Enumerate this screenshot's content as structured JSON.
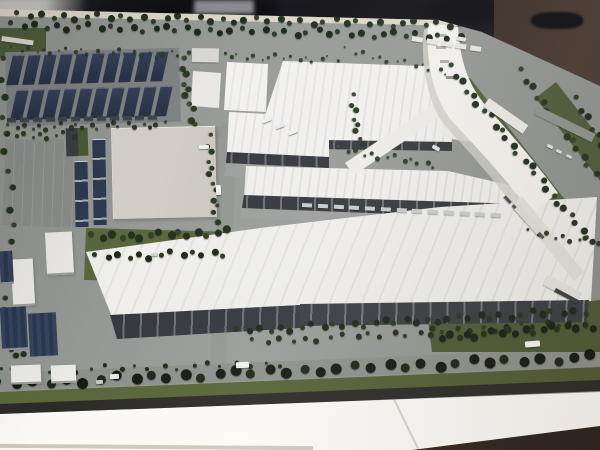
{
  "meta": {
    "description": "Photograph of an architectural scale model of a large factory campus (white plant halls, curved landmark tower, rooftop-solar carport field, perimeter canal and tree-lined boulevard) displayed on a white table in a dark room",
    "no_visible_text": true
  },
  "scene": {
    "regions": [
      {
        "label": "solar-carport-field",
        "position": "top-left"
      },
      {
        "label": "perimeter-canal",
        "position": "top and right"
      },
      {
        "label": "curved-landmark-tower",
        "position": "top-right"
      },
      {
        "label": "factory-halls",
        "position": "center"
      },
      {
        "label": "logistics-sheds",
        "position": "left"
      },
      {
        "label": "tree-lined-boulevard",
        "position": "bottom"
      },
      {
        "label": "white-display-table",
        "position": "bottom edge"
      },
      {
        "label": "dark-exhibition-room",
        "position": "top edge"
      }
    ]
  },
  "colors": {
    "bg": "#191921",
    "bg_blob": "#0e0e13",
    "bg_light": "#c4c3bf",
    "bg_brown": "#3a2f28",
    "pavement": "#90938f",
    "pavement_light": "#9da09c",
    "road": "#8d908b",
    "parking": "#8a8d89",
    "canal": "#4f7da6",
    "canal_hi": "#85aec9",
    "bank": "#4c5c39",
    "grass": "#5a673e",
    "grass_dark": "#4d5a36",
    "verge": "#5d6a3c",
    "tree": "#22301e",
    "tree_dark": "#141c12",
    "roof": "#eeedea",
    "roof_ridge": "#dedddb",
    "facade": "#35383d",
    "facade2": "#3a3d42",
    "flat": "#d7d3cb",
    "navy": "#2e3a51",
    "solar": "#36425a",
    "solar_dark": "#2a3448",
    "frame": "#ddd6c9",
    "table": "#f6f4ef",
    "table_sh": "#cdc7ba",
    "floor": "#43362e",
    "floor_dark": "#2a221d",
    "edge": "#2c2b27",
    "white_bldg": "#eae9e5"
  },
  "solar_field": {
    "rows": 2,
    "cols": 10,
    "strip_w": 12,
    "strip_h": 30,
    "gap_x": 4,
    "row_gap": 5,
    "row_shift": 3
  },
  "tree_bands": [
    {
      "name": "treeline-top-outer",
      "x": 16,
      "y": 15,
      "len": 452,
      "ang": 1.2,
      "count": 40,
      "size": 6,
      "c1": "#23321f",
      "c2": "#2e4026"
    },
    {
      "name": "treeline-top-inner",
      "x": 10,
      "y": 25,
      "len": 458,
      "ang": 1.4,
      "count": 42,
      "size": 6,
      "c1": "#1d2a1b",
      "c2": "#2a3a24"
    },
    {
      "name": "canal-top-bushes",
      "x": 12,
      "y": 49,
      "len": 330,
      "ang": 1.8,
      "count": 44,
      "size": 3,
      "c1": "#2f4129",
      "c2": "#3a4d31"
    },
    {
      "name": "treeline-canal-right-west",
      "x": 449,
      "y": 66,
      "len": 235,
      "ang": 51,
      "count": 26,
      "size": 6,
      "c1": "#22301e",
      "c2": "#2e4027"
    },
    {
      "name": "treeline-canal-right-east",
      "x": 519,
      "y": 70,
      "len": 230,
      "ang": 53,
      "count": 24,
      "size": 6,
      "c1": "#26341f",
      "c2": "#32442a"
    },
    {
      "name": "treeline-right-edge",
      "x": 574,
      "y": 98,
      "len": 210,
      "ang": 56,
      "count": 20,
      "size": 6,
      "c1": "#202d1c",
      "c2": "#2b3b22"
    },
    {
      "name": "treeline-below-solar",
      "x": 8,
      "y": 127,
      "len": 162,
      "ang": -1,
      "count": 22,
      "size": 4,
      "c1": "#2a3a23",
      "c2": "#354830"
    },
    {
      "name": "grove-center-left-a",
      "x": 90,
      "y": 237,
      "len": 142,
      "ang": -2,
      "count": 15,
      "size": 7,
      "c1": "#22301d",
      "c2": "#31432a"
    },
    {
      "name": "grove-center-left-b",
      "x": 94,
      "y": 257,
      "len": 138,
      "ang": -2,
      "count": 13,
      "size": 6,
      "c1": "#1d2a1a",
      "c2": "#293821"
    },
    {
      "name": "treeline-b6-east",
      "x": 208,
      "y": 135,
      "len": 92,
      "ang": 84,
      "count": 12,
      "size": 5,
      "c1": "#28381f",
      "c2": "#33452a"
    },
    {
      "name": "grove-solar-east",
      "x": 182,
      "y": 58,
      "len": 72,
      "ang": 80,
      "count": 10,
      "size": 6,
      "c1": "#2b3b24",
      "c2": "#364830"
    },
    {
      "name": "treeline-b1-east",
      "x": 351,
      "y": 95,
      "len": 56,
      "ang": 78,
      "count": 8,
      "size": 5,
      "c1": "#2a3a23",
      "c2": "#344630"
    },
    {
      "name": "treeline-apron",
      "x": 338,
      "y": 149,
      "len": 104,
      "ang": 9,
      "count": 13,
      "size": 4,
      "c1": "#2e3f26",
      "c2": "#395032"
    },
    {
      "name": "treeline-facade-south-a",
      "x": 236,
      "y": 331,
      "len": 356,
      "ang": -3.4,
      "count": 34,
      "size": 6,
      "c1": "#1c281a",
      "c2": "#28361f"
    },
    {
      "name": "treeline-facade-south-b",
      "x": 252,
      "y": 342,
      "len": 330,
      "ang": -3.4,
      "count": 26,
      "size": 5,
      "c1": "#232f1d",
      "c2": "#2d3c24"
    },
    {
      "name": "treeline-boulevard",
      "x": -6,
      "y": 384,
      "len": 610,
      "ang": -2.6,
      "count": 36,
      "size": 10,
      "c1": "#141c12",
      "c2": "#1d2817"
    },
    {
      "name": "treeline-road-north",
      "x": 2,
      "y": 371,
      "len": 290,
      "ang": -1.6,
      "count": 20,
      "size": 4,
      "c1": "#202c1a",
      "c2": "#2a3a22"
    },
    {
      "name": "treeline-west-edge",
      "x": 1,
      "y": 58,
      "len": 330,
      "ang": 86,
      "count": 18,
      "size": 6,
      "c1": "#253420",
      "c2": "#2f4128"
    },
    {
      "name": "treeline-parking-north",
      "x": 6,
      "y": 135,
      "len": 72,
      "ang": 0,
      "count": 9,
      "size": 4,
      "c1": "#2b3b24",
      "c2": "#354830"
    },
    {
      "name": "grove-parking-southeast",
      "x": 430,
      "y": 338,
      "len": 168,
      "ang": -4.5,
      "count": 20,
      "size": 7,
      "c1": "#182315",
      "c2": "#243018"
    },
    {
      "name": "grove-southwest",
      "x": 3,
      "y": 298,
      "len": 82,
      "ang": 80,
      "count": 10,
      "size": 6,
      "c1": "#22301d",
      "c2": "#2c3a24"
    },
    {
      "name": "canal-bend-bushes",
      "x": 345,
      "y": 50,
      "len": 112,
      "ang": 12,
      "count": 13,
      "size": 3,
      "c1": "#31422a",
      "c2": "#3c5033"
    },
    {
      "name": "treeline-b5-northeast",
      "x": 528,
      "y": 232,
      "len": 75,
      "ang": 8,
      "count": 9,
      "size": 4,
      "c1": "#2c3c25",
      "c2": "#364a2e"
    }
  ],
  "dash_rows": [
    {
      "name": "carport-row",
      "x": 7,
      "y": 120,
      "len": 154,
      "ang": -1,
      "count": 12,
      "w": 9,
      "h": 4,
      "c": "#40454c"
    },
    {
      "name": "dock-container-row",
      "x": 302,
      "y": 205,
      "len": 205,
      "ang": 3,
      "count": 13,
      "w": 10,
      "h": 4,
      "c": "#c6cacb"
    },
    {
      "name": "canal-top-station",
      "x": 412,
      "y": 38,
      "len": 74,
      "ang": 9,
      "count": 5,
      "w": 11,
      "h": 5,
      "c": "#e7e5e0"
    },
    {
      "name": "rail-platform-dashes",
      "x": 505,
      "y": 196,
      "len": 60,
      "ang": 47,
      "count": 5,
      "w": 9,
      "h": 3,
      "c": "#4a4e52"
    }
  ],
  "platforms": [
    {
      "name": "canal-station-west",
      "x": 489,
      "y": 98,
      "w": 48,
      "h": 10,
      "rot": 35,
      "c": "#eae8e3"
    },
    {
      "name": "canal-station-mid",
      "x": 520,
      "y": 204,
      "w": 34,
      "h": 8,
      "rot": 48,
      "c": "#dddcd6"
    },
    {
      "name": "canal-station-south",
      "x": 548,
      "y": 275,
      "w": 38,
      "h": 11,
      "rot": 28,
      "c": "#e4e2dd"
    },
    {
      "name": "canal-bridge-road",
      "x": 538,
      "y": 106,
      "w": 64,
      "h": 9,
      "rot": 26,
      "c": "#90938f"
    },
    {
      "name": "station-platform-dark",
      "x": 556,
      "y": 288,
      "w": 26,
      "h": 4,
      "rot": 28,
      "c": "#3c4046"
    },
    {
      "name": "gatehouse",
      "x": 192,
      "y": 48,
      "w": 27,
      "h": 14,
      "rot": 1,
      "c": "#d8d7d3"
    },
    {
      "name": "footpath-northwest",
      "x": 2,
      "y": 36,
      "w": 32,
      "h": 5,
      "rot": 8,
      "c": "#d9d6cd"
    }
  ],
  "navy_sheds": [
    {
      "x": 75,
      "y": 161,
      "w": 13,
      "h": 65
    },
    {
      "x": 93,
      "y": 139,
      "w": 13,
      "h": 85
    }
  ],
  "white_sheds": [
    {
      "x": 46,
      "y": 232,
      "w": 27,
      "h": 41,
      "rot": -3
    },
    {
      "x": 12,
      "y": 259,
      "w": 22,
      "h": 45,
      "rot": -3
    },
    {
      "x": 11,
      "y": 365,
      "w": 30,
      "h": 17,
      "rot": -2
    },
    {
      "x": 51,
      "y": 365,
      "w": 25,
      "h": 16,
      "rot": -2
    }
  ],
  "canopies": [
    {
      "x": 1,
      "y": 307,
      "w": 26,
      "h": 41
    },
    {
      "x": 29,
      "y": 313,
      "w": 28,
      "h": 43
    },
    {
      "x": 0,
      "y": 251,
      "w": 13,
      "h": 31
    }
  ],
  "vehicles": [
    {
      "x": 216,
      "y": 185,
      "w": 5,
      "h": 10,
      "c": "#f2f2f0",
      "r": -4
    },
    {
      "x": 262,
      "y": 118,
      "w": 9,
      "h": 4,
      "c": "#edeff0",
      "r": -20
    },
    {
      "x": 275,
      "y": 124,
      "w": 9,
      "h": 4,
      "c": "#e7eaeb",
      "r": -20
    },
    {
      "x": 288,
      "y": 130,
      "w": 9,
      "h": 4,
      "c": "#f0f2f2",
      "r": -20
    },
    {
      "x": 199,
      "y": 145,
      "w": 10,
      "h": 4,
      "c": "#eceeee",
      "r": -2
    },
    {
      "x": 236,
      "y": 362,
      "w": 13,
      "h": 6,
      "c": "#eff0ee",
      "r": -3
    },
    {
      "x": 525,
      "y": 341,
      "w": 15,
      "h": 6,
      "c": "#f4f4f2",
      "r": -4
    },
    {
      "x": 110,
      "y": 374,
      "w": 9,
      "h": 5,
      "c": "#e8e8e6",
      "r": -2
    },
    {
      "x": 432,
      "y": 146,
      "w": 8,
      "h": 4,
      "c": "#dfe2e3",
      "r": 30
    },
    {
      "x": 547,
      "y": 145,
      "w": 6,
      "h": 3,
      "c": "#e6e8e8",
      "r": 25
    },
    {
      "x": 556,
      "y": 150,
      "w": 6,
      "h": 3,
      "c": "#dde0e0",
      "r": 25
    },
    {
      "x": 566,
      "y": 155,
      "w": 6,
      "h": 3,
      "c": "#d4d7d7",
      "r": 25
    },
    {
      "x": 151,
      "y": 253,
      "w": 7,
      "h": 3,
      "c": "#d0d3d0",
      "r": -2
    },
    {
      "x": 457,
      "y": 37,
      "w": 9,
      "h": 4,
      "c": "#e4e2de",
      "r": 10
    },
    {
      "x": 96,
      "y": 380,
      "w": 7,
      "h": 4,
      "c": "#c4c6c3",
      "r": -2
    }
  ],
  "bg_blobs": [
    {
      "x": 96,
      "y": -8,
      "w": 70,
      "h": 38,
      "c": "#131318"
    },
    {
      "x": 152,
      "y": -10,
      "w": 130,
      "h": 44,
      "c": "#0e0e13"
    },
    {
      "x": 285,
      "y": -8,
      "w": 150,
      "h": 40,
      "c": "#15151a"
    },
    {
      "x": 420,
      "y": -8,
      "w": 90,
      "h": 36,
      "c": "#101014"
    }
  ]
}
